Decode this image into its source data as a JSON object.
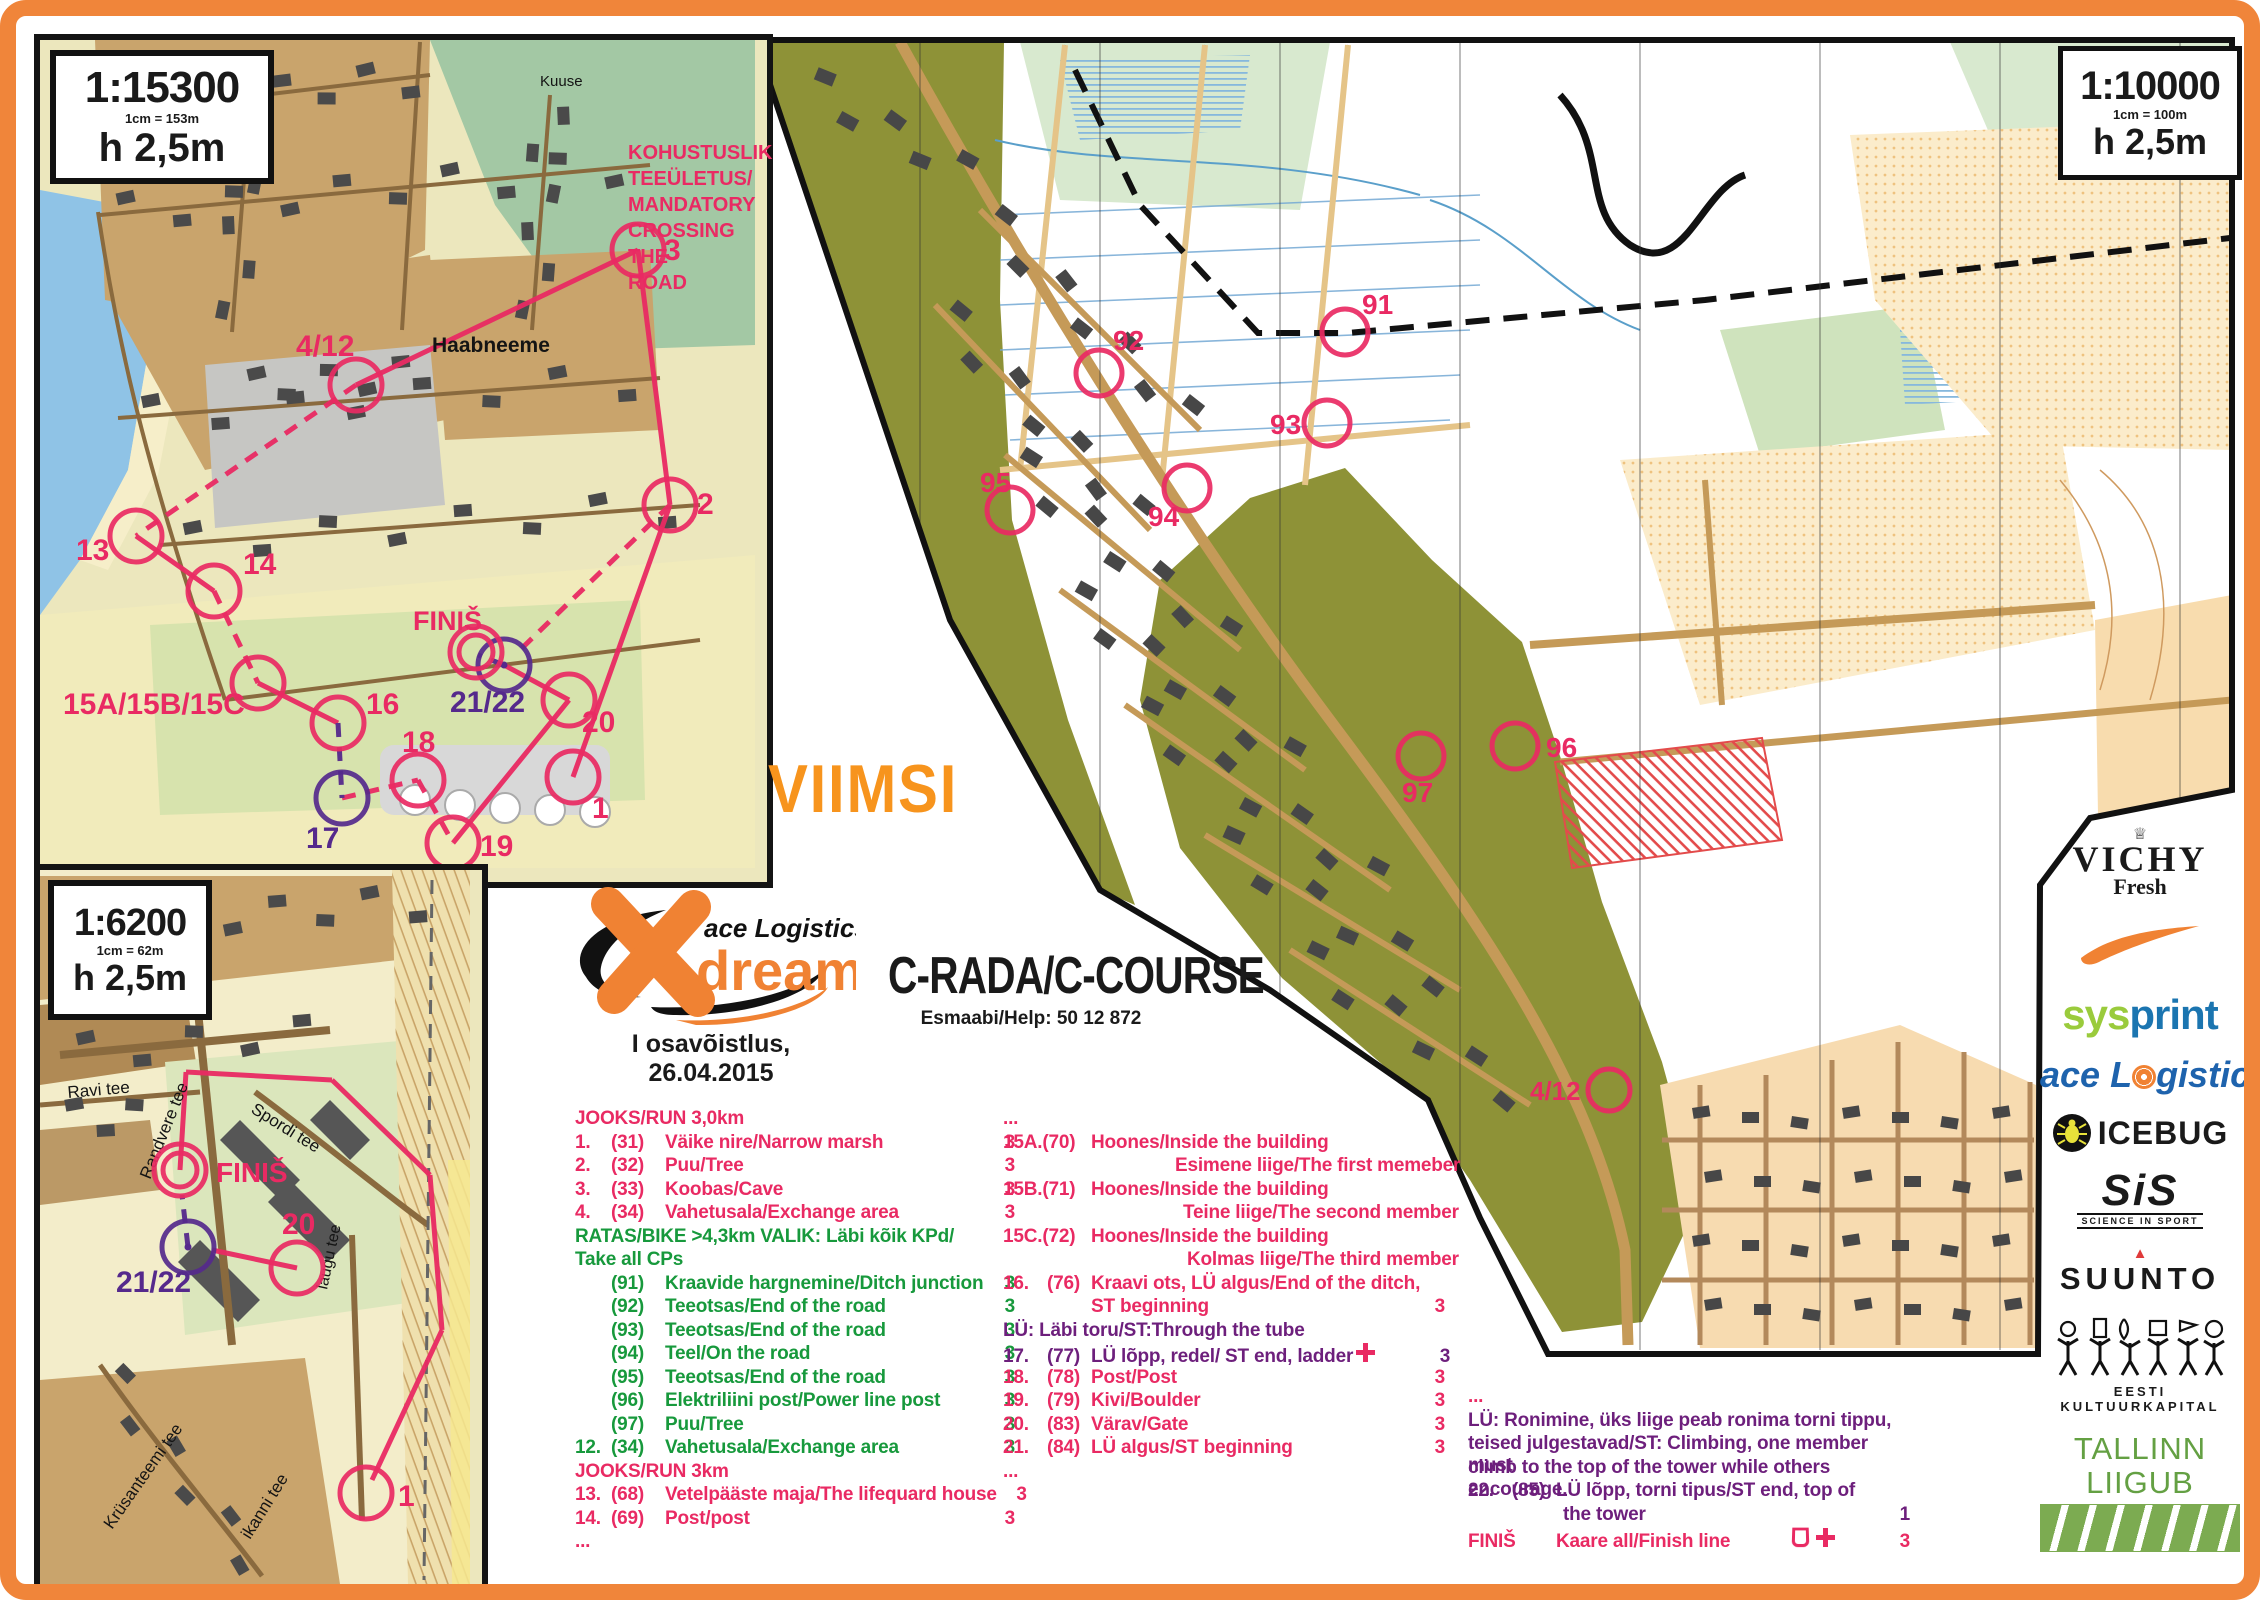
{
  "page": {
    "region_title": "VIIMSI",
    "event_caption": "I osavõistlus, 26.04.2015",
    "course_title": "C-RADA/C-COURSE",
    "help_line": "Esmaabi/Help: 50 12 872"
  },
  "logo": {
    "brand": "ace Logistics",
    "product": "dream"
  },
  "colors": {
    "border_orange": "#f0853a",
    "viimsi_orange": "#f7941d",
    "pink": "#e92a63",
    "green": "#17993c",
    "purple": "#6d1f7c",
    "purple_map": "#55298c",
    "map_olive": "#8e9237",
    "map_peach": "#fbeccb"
  },
  "scales": {
    "inset_top": {
      "scale": "1:15300",
      "equiv": "1cm = 153m",
      "contour": "h 2,5m"
    },
    "inset_bottom": {
      "scale": "1:6200",
      "equiv": "1cm = 62m",
      "contour": "h 2,5m"
    },
    "main": {
      "scale": "1:10000",
      "equiv": "1cm = 100m",
      "contour": "h 2,5m"
    }
  },
  "mandatory_crossing": [
    "KOHUSTUSLIK",
    "TEEÜLETUS/",
    "MANDATORY",
    "CROSSING THE",
    "ROAD"
  ],
  "maps": {
    "inset_top": {
      "labels": [
        {
          "t": "Kuuse",
          "x": 540,
          "y": 86,
          "s": 15
        },
        {
          "t": "Haabneeme",
          "x": 432,
          "y": 352,
          "s": 21,
          "b": 1
        }
      ],
      "controls": [
        {
          "t": "3",
          "cx": 638,
          "cy": 250,
          "lx": 664,
          "ly": 260,
          "c": "pink",
          "fs": 30
        },
        {
          "t": "2",
          "cx": 670,
          "cy": 505,
          "lx": 697,
          "ly": 514,
          "c": "pink",
          "fs": 30
        },
        {
          "t": "4/12",
          "cx": 356,
          "cy": 385,
          "lx": 296,
          "ly": 356,
          "c": "pink",
          "fs": 30
        },
        {
          "t": "13",
          "cx": 136,
          "cy": 536,
          "lx": 76,
          "ly": 560,
          "c": "pink",
          "fs": 30
        },
        {
          "t": "14",
          "cx": 214,
          "cy": 591,
          "lx": 243,
          "ly": 574,
          "c": "pink",
          "fs": 30
        },
        {
          "t": "15A/15B/15C",
          "cx": 258,
          "cy": 683,
          "lx": 63,
          "ly": 714,
          "c": "pink",
          "fs": 30
        },
        {
          "t": "16",
          "cx": 338,
          "cy": 723,
          "lx": 366,
          "ly": 714,
          "c": "pink",
          "fs": 30
        },
        {
          "t": "17",
          "cx": 342,
          "cy": 798,
          "lx": 306,
          "ly": 848,
          "c": "purple",
          "fs": 30
        },
        {
          "t": "18",
          "cx": 418,
          "cy": 780,
          "lx": 402,
          "ly": 752,
          "c": "pink",
          "fs": 30
        },
        {
          "t": "19",
          "cx": 453,
          "cy": 843,
          "lx": 480,
          "ly": 856,
          "c": "pink",
          "fs": 30
        },
        {
          "t": "20",
          "cx": 569,
          "cy": 700,
          "lx": 582,
          "ly": 732,
          "c": "pink",
          "fs": 30
        },
        {
          "t": "21/22",
          "cx": 504,
          "cy": 665,
          "dot": 1,
          "lx": 450,
          "ly": 712,
          "c": "purple",
          "fs": 30
        },
        {
          "t": "1",
          "cx": 573,
          "cy": 777,
          "lx": 592,
          "ly": 818,
          "c": "pink",
          "fs": 30
        },
        {
          "t": "FINIŠ",
          "f": 1,
          "cx": 476,
          "cy": 652,
          "lx": 413,
          "ly": 630,
          "c": "pink",
          "fs": 27
        }
      ]
    },
    "inset_bottom": {
      "labels": [
        {
          "t": "Ravi tee",
          "x": 68,
          "y": 1098,
          "s": 17,
          "r": -5
        },
        {
          "t": "Randvere tee",
          "x": 150,
          "y": 1180,
          "s": 17,
          "r": -68
        },
        {
          "t": "Spordi tee",
          "x": 250,
          "y": 1112,
          "s": 17,
          "r": 32
        },
        {
          "t": "laugu tee",
          "x": 327,
          "y": 1290,
          "s": 16,
          "r": -78
        },
        {
          "t": "Krüsanteemi tee",
          "x": 112,
          "y": 1530,
          "s": 17,
          "r": -55
        },
        {
          "t": "ikanni tee",
          "x": 250,
          "y": 1540,
          "s": 17,
          "r": -58
        }
      ],
      "controls": [
        {
          "t": "FINIŠ",
          "f": 1,
          "cx": 180,
          "cy": 1170,
          "lx": 216,
          "ly": 1182,
          "c": "pink",
          "fs": 28
        },
        {
          "t": "21/22",
          "cx": 188,
          "cy": 1247,
          "dot": 1,
          "lx": 116,
          "ly": 1292,
          "c": "purple",
          "fs": 30
        },
        {
          "t": "20",
          "cx": 297,
          "cy": 1268,
          "lx": 282,
          "ly": 1234,
          "c": "pink",
          "fs": 30
        },
        {
          "t": "1",
          "cx": 366,
          "cy": 1493,
          "lx": 398,
          "ly": 1506,
          "c": "pink",
          "fs": 30
        }
      ]
    },
    "main": {
      "controls": [
        {
          "t": "91",
          "cx": 1345,
          "cy": 332,
          "lx": 1362,
          "ly": 314,
          "c": "pink",
          "r": 23,
          "fs": 28
        },
        {
          "t": "92",
          "cx": 1099,
          "cy": 373,
          "lx": 1113,
          "ly": 350,
          "c": "pink",
          "r": 23,
          "fs": 28
        },
        {
          "t": "93",
          "cx": 1327,
          "cy": 423,
          "lx": 1270,
          "ly": 434,
          "c": "pink",
          "r": 23,
          "fs": 28
        },
        {
          "t": "94",
          "cx": 1187,
          "cy": 488,
          "lx": 1148,
          "ly": 526,
          "c": "pink",
          "r": 23,
          "fs": 28
        },
        {
          "t": "95",
          "cx": 1010,
          "cy": 510,
          "lx": 980,
          "ly": 492,
          "c": "pink",
          "r": 23,
          "fs": 28
        },
        {
          "t": "96",
          "cx": 1515,
          "cy": 746,
          "lx": 1546,
          "ly": 757,
          "c": "pink",
          "r": 23,
          "fs": 28
        },
        {
          "t": "97",
          "cx": 1421,
          "cy": 756,
          "lx": 1402,
          "ly": 802,
          "c": "pink",
          "r": 23,
          "fs": 28
        },
        {
          "t": "4/12",
          "cx": 1609,
          "cy": 1090,
          "lx": 1530,
          "ly": 1100,
          "c": "pink",
          "r": 21,
          "fs": 26
        }
      ]
    }
  },
  "course_list": {
    "left": [
      {
        "h": "JOOKS/RUN 3,0km",
        "c": "pink"
      },
      {
        "n": "1.",
        "k": "(31)",
        "t": "Väike nire/Narrow marsh",
        "p": "3",
        "c": "pink"
      },
      {
        "n": "2.",
        "k": "(32)",
        "t": "Puu/Tree",
        "p": "3",
        "c": "pink"
      },
      {
        "n": "3.",
        "k": "(33)",
        "t": "Koobas/Cave",
        "p": "3",
        "c": "pink"
      },
      {
        "n": "4.",
        "k": "(34)",
        "t": "Vahetusala/Exchange area",
        "p": "3",
        "c": "pink"
      },
      {
        "h": "RATAS/BIKE >4,3km VALIK: Läbi kõik KPd/",
        "c": "green"
      },
      {
        "h": "Take all CPs",
        "c": "green"
      },
      {
        "n": "",
        "k": "(91)",
        "t": "Kraavide hargnemine/Ditch junction",
        "p": "3",
        "c": "green"
      },
      {
        "n": "",
        "k": "(92)",
        "t": "Teeotsas/End of the road",
        "p": "3",
        "c": "green"
      },
      {
        "n": "",
        "k": "(93)",
        "t": "Teeotsas/End of the road",
        "p": "3",
        "c": "green"
      },
      {
        "n": "",
        "k": "(94)",
        "t": "Teel/On the road",
        "p": "3",
        "c": "green"
      },
      {
        "n": "",
        "k": "(95)",
        "t": "Teeotsas/End of the road",
        "p": "3",
        "c": "green"
      },
      {
        "n": "",
        "k": "(96)",
        "t": "Elektriliini post/Power line post",
        "p": "3",
        "c": "green"
      },
      {
        "n": "",
        "k": "(97)",
        "t": "Puu/Tree",
        "p": "3",
        "c": "green"
      },
      {
        "n": "12.",
        "k": "(34)",
        "t": "Vahetusala/Exchange area",
        "p": "3",
        "c": "green"
      },
      {
        "h": "JOOKS/RUN 3km",
        "c": "pink"
      },
      {
        "n": "13.",
        "k": "(68)",
        "t": "Vetelpääste maja/The lifequard house",
        "p": "3",
        "c": "pink"
      },
      {
        "n": "14.",
        "k": "(69)",
        "t": "Post/post",
        "p": "3",
        "c": "pink"
      },
      {
        "h": "...",
        "c": "pink"
      }
    ],
    "right": [
      {
        "h": "...",
        "c": "pink"
      },
      {
        "n": "15A.(70)",
        "t": "Hoones/Inside the building",
        "c": "pink"
      },
      {
        "cont": 172,
        "t": "Esimene liige/The first memeber",
        "c": "pink"
      },
      {
        "n": "15B.(71)",
        "t": "Hoones/Inside the building",
        "c": "pink"
      },
      {
        "cont": 180,
        "t": "Teine liige/The second member",
        "c": "pink"
      },
      {
        "n": "15C.(72)",
        "t": "Hoones/Inside the building",
        "c": "pink"
      },
      {
        "cont": 184,
        "t": "Kolmas liige/The third member",
        "c": "pink"
      },
      {
        "n": "16.",
        "k": "(76)",
        "t": "Kraavi ots, LÜ algus/End of the ditch,",
        "c": "pink"
      },
      {
        "cont": 88,
        "t": "ST beginning",
        "p": "3",
        "c": "pink"
      },
      {
        "h": "LÜ: Läbi toru/ST:Through the tube",
        "c": "purple"
      },
      {
        "n": "17.",
        "k": "(77)",
        "t": "LÜ lõpp, redel/ ST end, ladder",
        "p": "3",
        "c": "purple",
        "icon": "cross"
      },
      {
        "n": "18.",
        "k": "(78)",
        "t": "Post/Post",
        "p": "3",
        "c": "pink"
      },
      {
        "n": "19.",
        "k": "(79)",
        "t": "Kivi/Boulder",
        "p": "3",
        "c": "pink"
      },
      {
        "n": "20.",
        "k": "(83)",
        "t": "Värav/Gate",
        "p": "3",
        "c": "pink"
      },
      {
        "n": "21.",
        "k": "(84)",
        "t": "LÜ algus/ST beginning",
        "p": "3",
        "c": "pink"
      },
      {
        "h": "...",
        "c": "pink"
      }
    ],
    "notes": [
      {
        "h": "...",
        "c": "pink"
      },
      {
        "h": "LÜ: Ronimine, üks liige peab ronima torni tippu,",
        "c": "purple"
      },
      {
        "h": "teised julgestavad/ST: Climbing, one member must",
        "c": "purple"
      },
      {
        "h": "climb to the top of the tower while others encourage.",
        "c": "purple"
      },
      {
        "n": "22.",
        "k": "(85)",
        "t": "LÜ lõpp, torni tipus/ST end, top of",
        "c": "purple"
      },
      {
        "cont": 95,
        "t": "the tower",
        "p": "1",
        "c": "purple"
      },
      {
        "n": "FINIŠ",
        "t": "Kaare all/Finish line",
        "p": "3",
        "c": "pink",
        "icon": "cup-cross"
      }
    ]
  },
  "sponsors": {
    "vichy": {
      "name": "VICHY",
      "tagline": "Fresh"
    },
    "sysprint": {
      "part1": "sys",
      "part2": "print"
    },
    "ace": {
      "part1": "ace L",
      "part2": "gistics"
    },
    "icebug": {
      "name": "ICEBUG"
    },
    "sis": {
      "name": "SiS",
      "tagline": "SCIENCE IN SPORT"
    },
    "suunto": {
      "name": "SUUNTO"
    },
    "kulka": {
      "name": "EESTI KULTUURKAPITAL"
    },
    "tallinn": {
      "name": "TALLINN LIIGUB"
    }
  }
}
